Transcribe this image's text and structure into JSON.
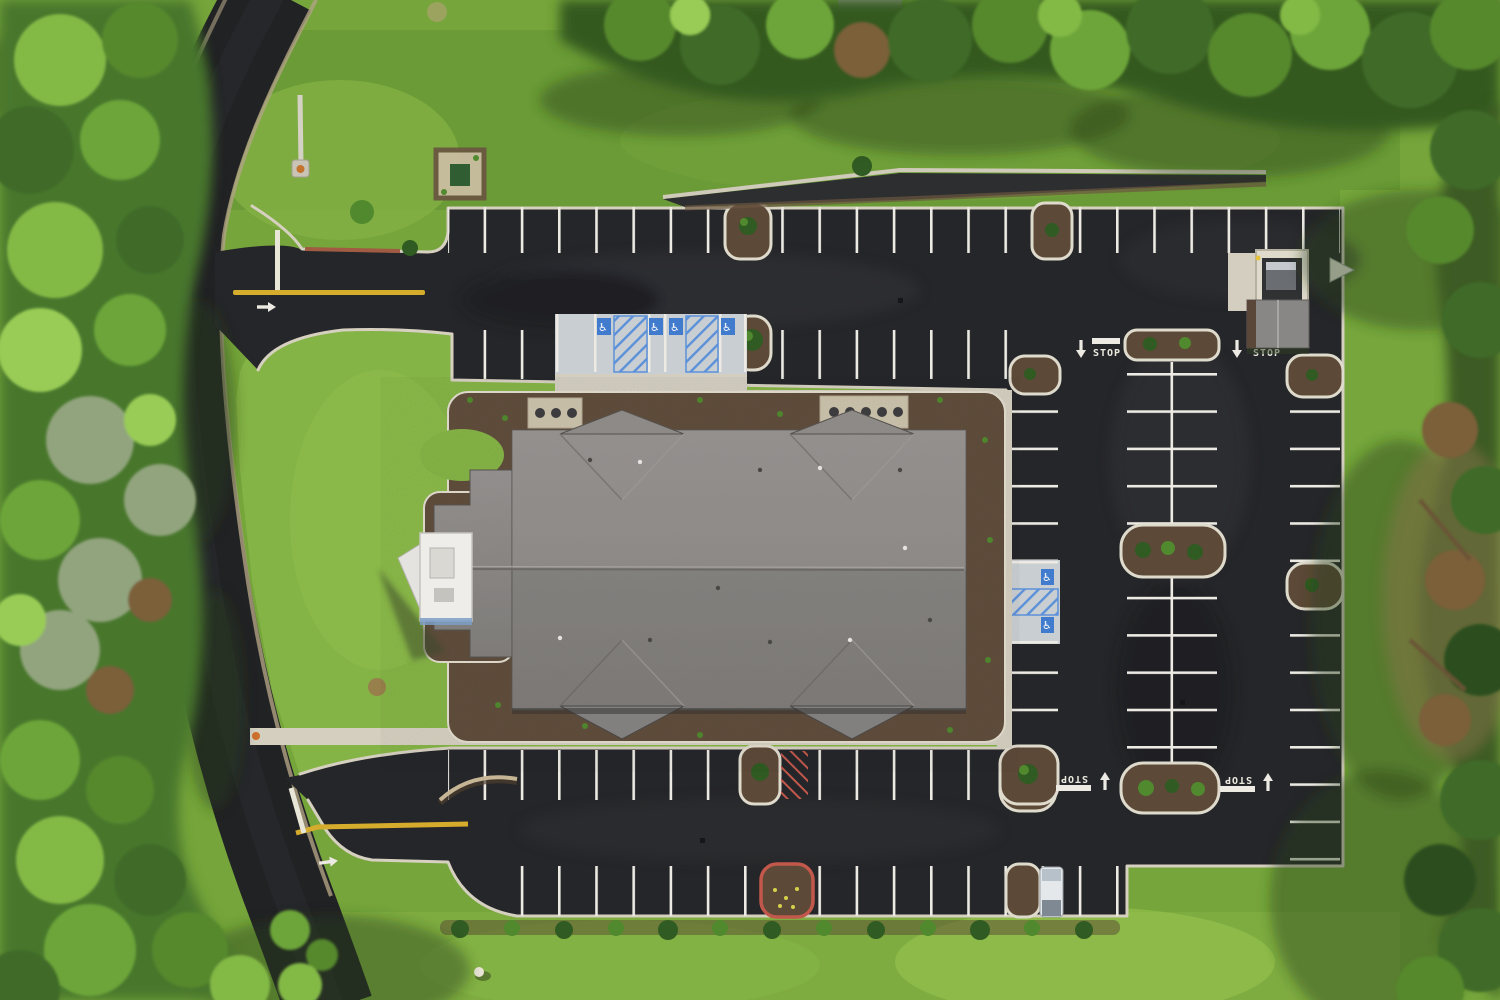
{
  "scene": {
    "title": "Aerial top-down drone photo of a new commercial building with freshly paved parking lot",
    "setting": "building surrounded by lawns, perimeter road and tree lines"
  },
  "markings": {
    "stop_label": "STOP",
    "stop_marking_count": 4,
    "accessible_symbol": "♿",
    "accessible_space_count": 6,
    "turn_arrow_direction": "right",
    "lane_arrow_directions": [
      "down",
      "down",
      "up",
      "up"
    ],
    "yellow_centerline_count": 2
  },
  "site": {
    "building": {
      "roof": "gray shingle hip roof with 4 gable projections",
      "portico": "white entry canopy at west end",
      "hvac_pads": 2
    },
    "parking": {
      "landscaped_islands": 12,
      "accessible_rows": [
        {
          "location": "north row",
          "spaces": 4
        },
        {
          "location": "east row",
          "spaces": 2
        }
      ],
      "vehicles": [
        {
          "type": "white van",
          "location": "south parking row"
        }
      ]
    },
    "features": [
      "dumpster enclosure",
      "storage shed",
      "retaining wall strip",
      "light pole",
      "utility pad",
      "curb ramp",
      "shrub row",
      "red curb island",
      "fire-lane hatching"
    ]
  },
  "colors": {
    "asphalt": "#232427",
    "road": "#1e1f22",
    "grass": "#76a739",
    "roof": "#8b8885",
    "concrete": "#d8d2c2",
    "stall_line": "#f0eee6",
    "centerline_yellow": "#d9ae2b",
    "accessible_blue": "#3f7bd0",
    "red_curb": "#c4574a",
    "mulch": "#5c4836"
  }
}
